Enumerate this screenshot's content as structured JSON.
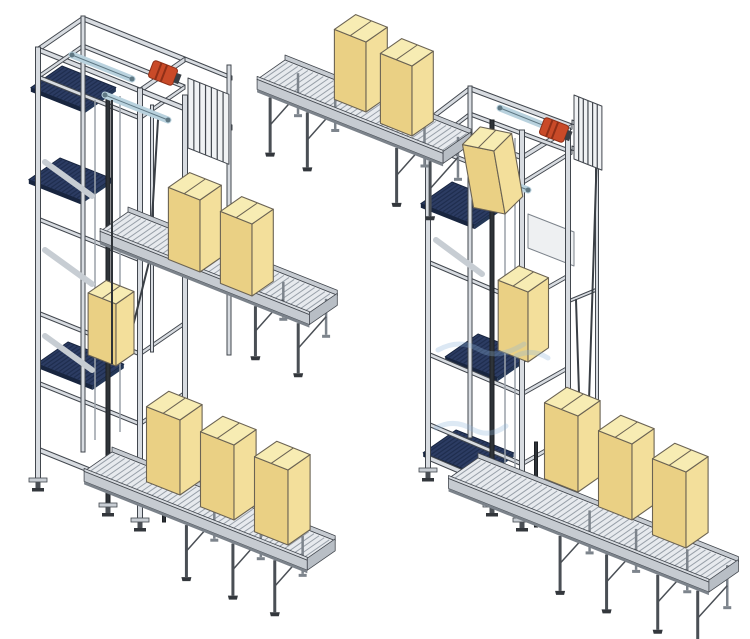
{
  "meta": {
    "background": "#ffffff",
    "canvas": {
      "w": 750,
      "h": 639
    }
  },
  "palette": {
    "box_left": "#ead084",
    "box_right": "#f3df9b",
    "box_top": "#f7ecb3",
    "box_outline": "#6b6353",
    "frame_fill": "#d8dce1",
    "frame_line": "#42474e",
    "frame_dark": "#2e3338",
    "frame_dark_line": "#1c1f23",
    "deck": "#e7eaee",
    "roller_line": "#98a0a9",
    "rail": "#c6cbd1",
    "rail_top": "#d7dbe0",
    "rail_dark": "#7c838b",
    "end_plate": "#b8bec5",
    "belt": "#2c3c63",
    "belt_stripe": "#1f2e4f",
    "belt_edge": "#18253f",
    "belt_side": "#243757",
    "motor": "#c94a28",
    "motor_dark": "#8f2f17",
    "shaft": "#b9d2de",
    "shaft_line": "#5f7884",
    "bar": "#c7cdd3",
    "leg": "#4a4f55",
    "leg_far": "#7d848c",
    "foot": "#33373c",
    "plate_fill": "#eef0f2",
    "ladder_fill": "#f0f2f4",
    "rail_guide": "#9aa1a9",
    "watermark": "#8fb6dc"
  },
  "scene": {
    "axes": {
      "a": [
        0.93,
        0.37
      ],
      "b": [
        -0.82,
        0.57
      ]
    },
    "machines": [
      {
        "name": "left-vertical-conveyor",
        "tower": {
          "belts": [
            [
              62,
              66,
              58,
              38
            ],
            [
              60,
              158,
              56,
              38
            ],
            [
              68,
              342,
              60,
              38
            ]
          ],
          "beams": [
            [
              83,
              16,
              38,
              47,
              5
            ],
            [
              83,
              16,
              185,
              57,
              5
            ],
            [
              38,
              47,
              140,
              88,
              5
            ],
            [
              185,
              57,
              140,
              88,
              5
            ],
            [
              83,
              44,
              38,
              75,
              4
            ],
            [
              83,
              44,
              185,
              85,
              4
            ],
            [
              38,
              75,
              140,
              116,
              4
            ],
            [
              185,
              85,
              140,
              116,
              4
            ],
            [
              185,
              57,
              232,
              76,
              4
            ],
            [
              140,
              88,
              232,
              125,
              5
            ],
            [
              38,
              217,
              140,
              258,
              4
            ],
            [
              38,
              311,
              140,
              352,
              4
            ],
            [
              38,
              381,
              140,
              422,
              4
            ],
            [
              140,
              258,
              185,
              227,
              4
            ],
            [
              140,
              352,
              185,
              321,
              4
            ],
            [
              140,
              422,
              185,
              391,
              4
            ],
            [
              38,
              447,
              140,
              488,
              5
            ],
            [
              140,
              488,
              185,
              457,
              5
            ]
          ],
          "columns": [
            {
              "b": [
                83,
                452
              ],
              "h": 436,
              "w": 4
            },
            {
              "b": [
                38,
                480
              ],
              "h": 433,
              "w": 5,
              "base": 1
            },
            {
              "b": [
                185,
                492
              ],
              "h": 397,
              "w": 5,
              "base": 1
            },
            {
              "b": [
                229,
                355
              ],
              "h": 290,
              "w": 4
            },
            {
              "b": [
                152,
                352
              ],
              "h": 247,
              "w": 3
            },
            {
              "b": [
                140,
                520
              ],
              "h": 432,
              "w": 5,
              "base": 1
            },
            {
              "b": [
                108,
                505
              ],
              "h": 410,
              "w": 4,
              "tone": "dark",
              "base": 1
            },
            {
              "b": [
                164,
                522
              ],
              "h": 80,
              "w": 3,
              "tone": "dark"
            }
          ],
          "rails": [
            [
              95,
              100,
              95,
              440
            ],
            [
              120,
              96,
              120,
              432
            ]
          ],
          "bars": [
            [
              45,
              162,
              92,
              196
            ],
            [
              45,
              250,
              92,
              284
            ],
            [
              45,
              336,
              92,
              370
            ]
          ],
          "braces": [
            [
              150,
              258,
              132,
              330
            ],
            [
              158,
              120,
              150,
              252
            ]
          ],
          "shafts": [
            [
              72,
              55,
              132,
              79
            ],
            [
              105,
              95,
              168,
              120
            ]
          ],
          "motors": [
            [
              163,
              73
            ]
          ],
          "ladders": [
            [
              188,
              78,
              44,
              70,
              7
            ]
          ],
          "plates": [],
          "overlays": [
            [
              112,
              100,
              112,
              364
            ]
          ]
        },
        "conveyors": [
          {
            "o": [
              128,
              212
            ],
            "len": 225,
            "w": 34,
            "legs": [
              167,
              213
            ],
            "legH": 50
          },
          {
            "o": [
              112,
              452
            ],
            "len": 240,
            "w": 34,
            "legs": [
              110,
              160,
              205
            ],
            "legH": 52
          }
        ],
        "boxes": [
          [
            200,
            272,
            34,
            26,
            72,
            0
          ],
          [
            252,
            296,
            34,
            26,
            72,
            0
          ],
          [
            116,
            366,
            30,
            22,
            62,
            0
          ],
          [
            180,
            495,
            36,
            27,
            75,
            0
          ],
          [
            234,
            520,
            36,
            27,
            75,
            0
          ],
          [
            288,
            545,
            36,
            27,
            75,
            0
          ]
        ]
      },
      {
        "name": "right-vertical-conveyor",
        "tower": {
          "belts": [
            [
              452,
              182,
              58,
              38
            ],
            [
              478,
              334,
              56,
              40
            ],
            [
              456,
              430,
              62,
              40
            ]
          ],
          "beams": [
            [
              470,
              86,
              428,
              118,
              5
            ],
            [
              470,
              86,
              572,
              124,
              5
            ],
            [
              428,
              118,
              522,
              155,
              5
            ],
            [
              572,
              124,
              522,
              155,
              5
            ],
            [
              470,
              112,
              428,
              144,
              4
            ],
            [
              470,
              112,
              572,
              150,
              4
            ],
            [
              428,
              144,
              522,
              181,
              4
            ],
            [
              572,
              150,
              522,
              181,
              4
            ],
            [
              572,
              120,
              600,
              131,
              4
            ],
            [
              572,
              146,
              600,
              157,
              4
            ],
            [
              428,
              260,
              522,
              300,
              4
            ],
            [
              428,
              352,
              522,
              392,
              4
            ],
            [
              428,
              422,
              522,
              462,
              4
            ],
            [
              522,
              300,
              568,
              274,
              4
            ],
            [
              522,
              392,
              568,
              366,
              4
            ],
            [
              522,
              462,
              568,
              436,
              4
            ],
            [
              428,
              455,
              522,
              495,
              5
            ],
            [
              522,
              495,
              568,
              469,
              5
            ],
            [
              568,
              300,
              597,
              288,
              3
            ],
            [
              568,
              440,
              597,
              428,
              3
            ]
          ],
          "columns": [
            {
              "b": [
                470,
                438
              ],
              "h": 352,
              "w": 4
            },
            {
              "b": [
                428,
                470
              ],
              "h": 352,
              "w": 5,
              "base": 1
            },
            {
              "b": [
                568,
                488
              ],
              "h": 360,
              "w": 5,
              "base": 1
            },
            {
              "b": [
                597,
                462
              ],
              "h": 318,
              "w": 3
            },
            {
              "b": [
                522,
                520
              ],
              "h": 390,
              "w": 5,
              "base": 1
            },
            {
              "b": [
                492,
                505
              ],
              "h": 385,
              "w": 4,
              "tone": "dark",
              "base": 1
            },
            {
              "b": [
                536,
                527
              ],
              "h": 85,
              "w": 3,
              "tone": "dark"
            }
          ],
          "rails": [
            [
              505,
              140,
              505,
              495
            ],
            [
              515,
              138,
              515,
              492
            ]
          ],
          "bars": [
            [
              436,
              240,
              482,
              274
            ]
          ],
          "braces": [
            [
              597,
              150,
              588,
              432
            ],
            [
              576,
              300,
              580,
              424
            ]
          ],
          "shafts": [
            [
              500,
              108,
              560,
              132
            ],
            [
              470,
              168,
              528,
              190
            ]
          ],
          "motors": [
            [
              554,
              130
            ]
          ],
          "ladders": [
            [
              574,
              95,
              30,
              64,
              6
            ]
          ],
          "plates": [
            [
              528,
              214,
              574,
              232,
              34
            ]
          ],
          "overlays": []
        },
        "conveyors": [
          {
            "o": [
              285,
              60
            ],
            "len": 200,
            "w": 34,
            "legs": [
              14,
              54,
              150,
              186
            ],
            "legH": 55
          },
          {
            "o": [
              478,
              458
            ],
            "len": 280,
            "w": 36,
            "legs": [
              120,
              170,
              225,
              268
            ],
            "legH": 55
          }
        ],
        "boxes": [
          [
            366,
            112,
            34,
            26,
            70,
            0
          ],
          [
            412,
            136,
            34,
            26,
            70,
            0
          ],
          [
            505,
            214,
            32,
            25,
            64,
            -10
          ],
          [
            528,
            362,
            32,
            25,
            70,
            0
          ],
          [
            578,
            492,
            36,
            27,
            76,
            0
          ],
          [
            632,
            520,
            36,
            27,
            76,
            0
          ],
          [
            686,
            548,
            36,
            27,
            76,
            0
          ]
        ]
      }
    ],
    "watermark": {
      "opacity": 0.3,
      "strokes": [
        "M438,350 q22,-12 42,0 q18,10 44,-6",
        "M436,428 q18,-10 38,2 q16,8 32,-4",
        "M516,356 q16,-8 32,2"
      ]
    }
  }
}
